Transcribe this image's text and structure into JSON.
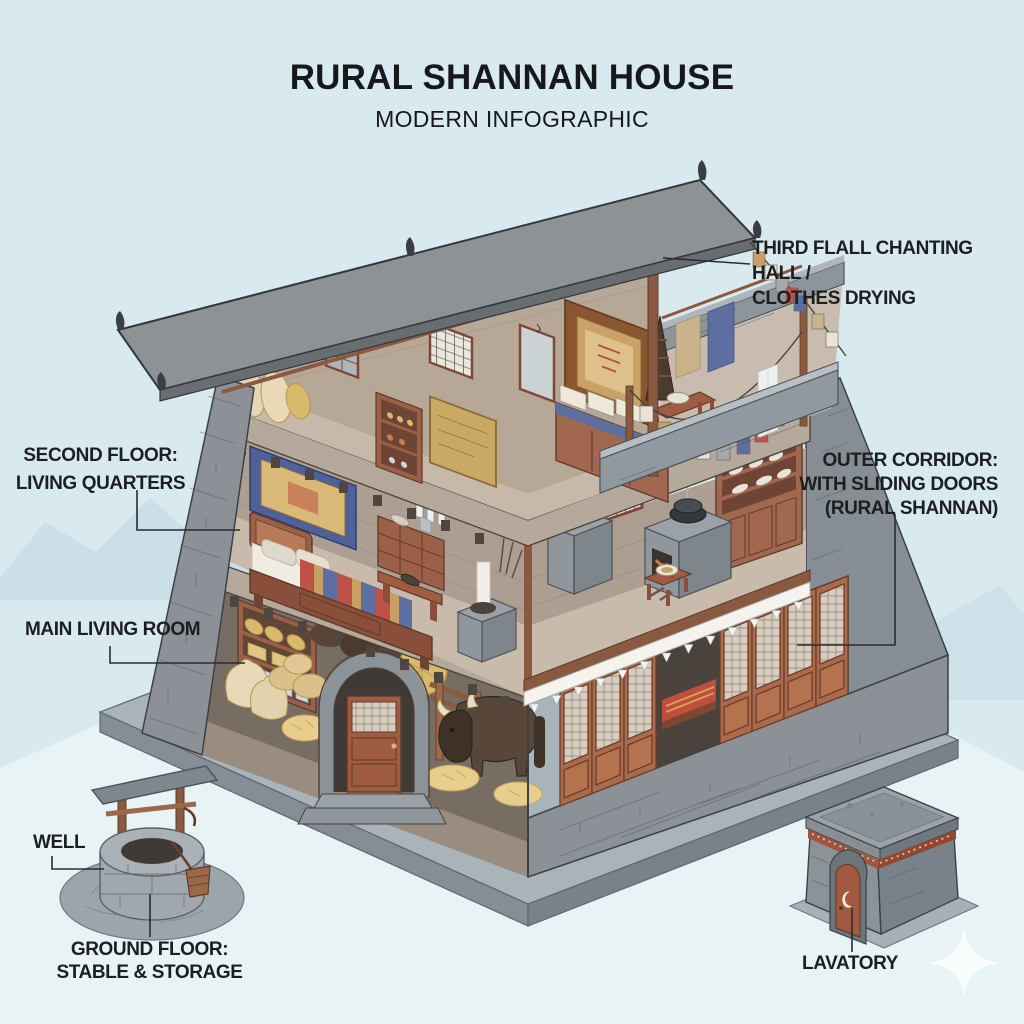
{
  "title": {
    "main": "RURAL SHANNAN HOUSE",
    "sub": "MODERN INFOGRAPHIC"
  },
  "labels": {
    "third_floor": {
      "line1": "THIRD FLALL CHANTING HALL /",
      "line2": "CLOTHES DRYING"
    },
    "second_floor": {
      "line1": "SECOND FLOOR:",
      "line2": "LIVING QUARTERS"
    },
    "outer_corridor": {
      "line1": "OUTER CORRIDOR:",
      "line2": "WITH SLIDING DOORS",
      "line3": "(RURAL SHANNAN)"
    },
    "main_living_room": {
      "line1": "MAIN LIVING ROOM"
    },
    "well": {
      "line1": "WELL"
    },
    "ground_floor": {
      "line1": "GROUND FLOOR:",
      "line2": "STABLE & STORAGE"
    },
    "lavatory": {
      "line1": "LAVATORY"
    }
  },
  "scene": {
    "items": [
      "three-story cutaway stone house",
      "slanted grey roof with finials",
      "rooftop chanting hall with thangka altar",
      "prayer flag lines",
      "clothes drying on rail",
      "bedroom with striped blanket bed",
      "kitchen with clay stoves and hutch",
      "stable with yak, hay and arched door",
      "outer corridor with sliding lattice doors and white valance",
      "stone well with wooden canopy and bucket",
      "stone lavatory hut with crescent door",
      "white sparkle"
    ]
  },
  "colors": {
    "background": "#d8eaef",
    "text": "#1d1e20",
    "roof": "#8d9295",
    "stone": "#8b9197",
    "wood": "#9c5f47",
    "interior_wall": "#b0a294",
    "accent_red": "#bf5147",
    "accent_blue": "#5c6fa0",
    "accent_gold": "#c9a064",
    "valance": "#f5f3ee"
  }
}
